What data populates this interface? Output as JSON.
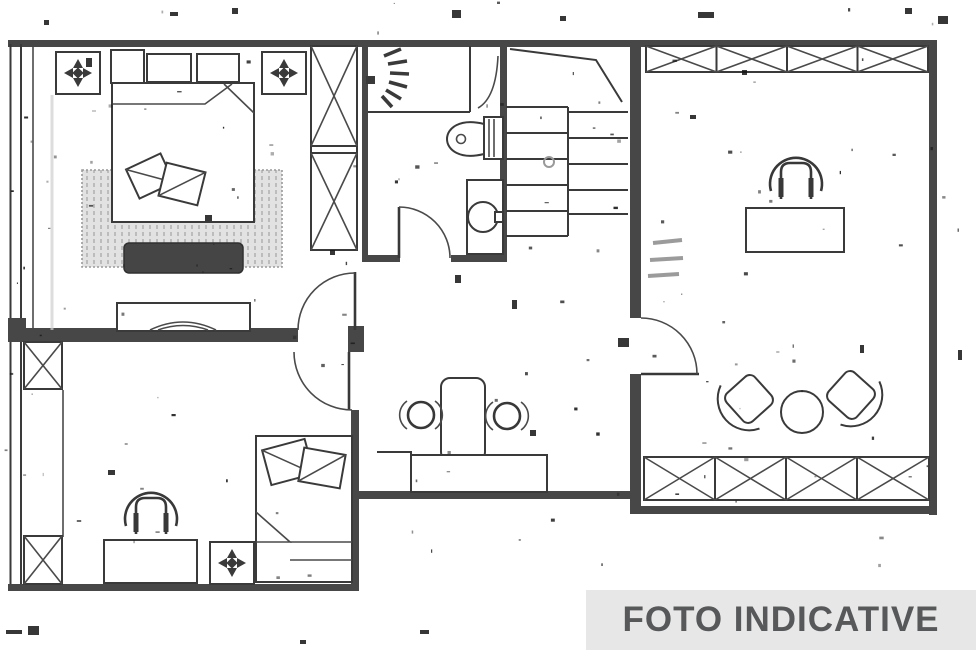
{
  "document": {
    "kind": "scanned-floor-plan"
  },
  "banner": {
    "label": "FOTO INDICATIVE",
    "background": "#e7e7e7",
    "text_color": "#57585a"
  },
  "colors": {
    "line": "#3a3a3a",
    "wall_fill": "#474747",
    "rug_fill": "#e2e2e2",
    "bench_fill": "#454545",
    "paper": "#ffffff"
  },
  "rooms": [
    {
      "id": "bedroom-master",
      "position": "top-left",
      "symbols": [
        "double-bed-icon",
        "pillow-icon",
        "cushions-icon",
        "rug-icon",
        "bench-icon",
        "wardrobe-x-icon",
        "ceiling-light-icon",
        "ceiling-light-icon",
        "dresser-tv-icon",
        "window-icon",
        "door-arc-icon"
      ]
    },
    {
      "id": "bathroom",
      "position": "top-center",
      "symbols": [
        "shower-spray-icon",
        "shower-screen-icon",
        "toilet-icon",
        "washbasin-icon",
        "door-arc-icon"
      ]
    },
    {
      "id": "staircase",
      "position": "top-center-right",
      "symbols": [
        "stair-steps-icon",
        "landing-break-line-icon"
      ]
    },
    {
      "id": "living-room",
      "position": "right",
      "symbols": [
        "window-x-strip-icon",
        "desk-icon",
        "office-chair-icon",
        "armchair-icon",
        "armchair-icon",
        "round-side-table-icon",
        "window-x-strip-icon",
        "door-arc-icon",
        "dimension-scribble"
      ]
    },
    {
      "id": "bedroom-second",
      "position": "bottom-left",
      "symbols": [
        "single-bed-icon",
        "pillow-icon",
        "office-chair-icon",
        "desk-icon",
        "ceiling-light-icon",
        "window-x-post-icon",
        "window-x-post-icon",
        "door-arc-icon"
      ]
    },
    {
      "id": "kitchenette-hall",
      "position": "bottom-center",
      "symbols": [
        "high-table-icon",
        "stool-icon",
        "stool-icon",
        "counter-icon"
      ]
    }
  ]
}
